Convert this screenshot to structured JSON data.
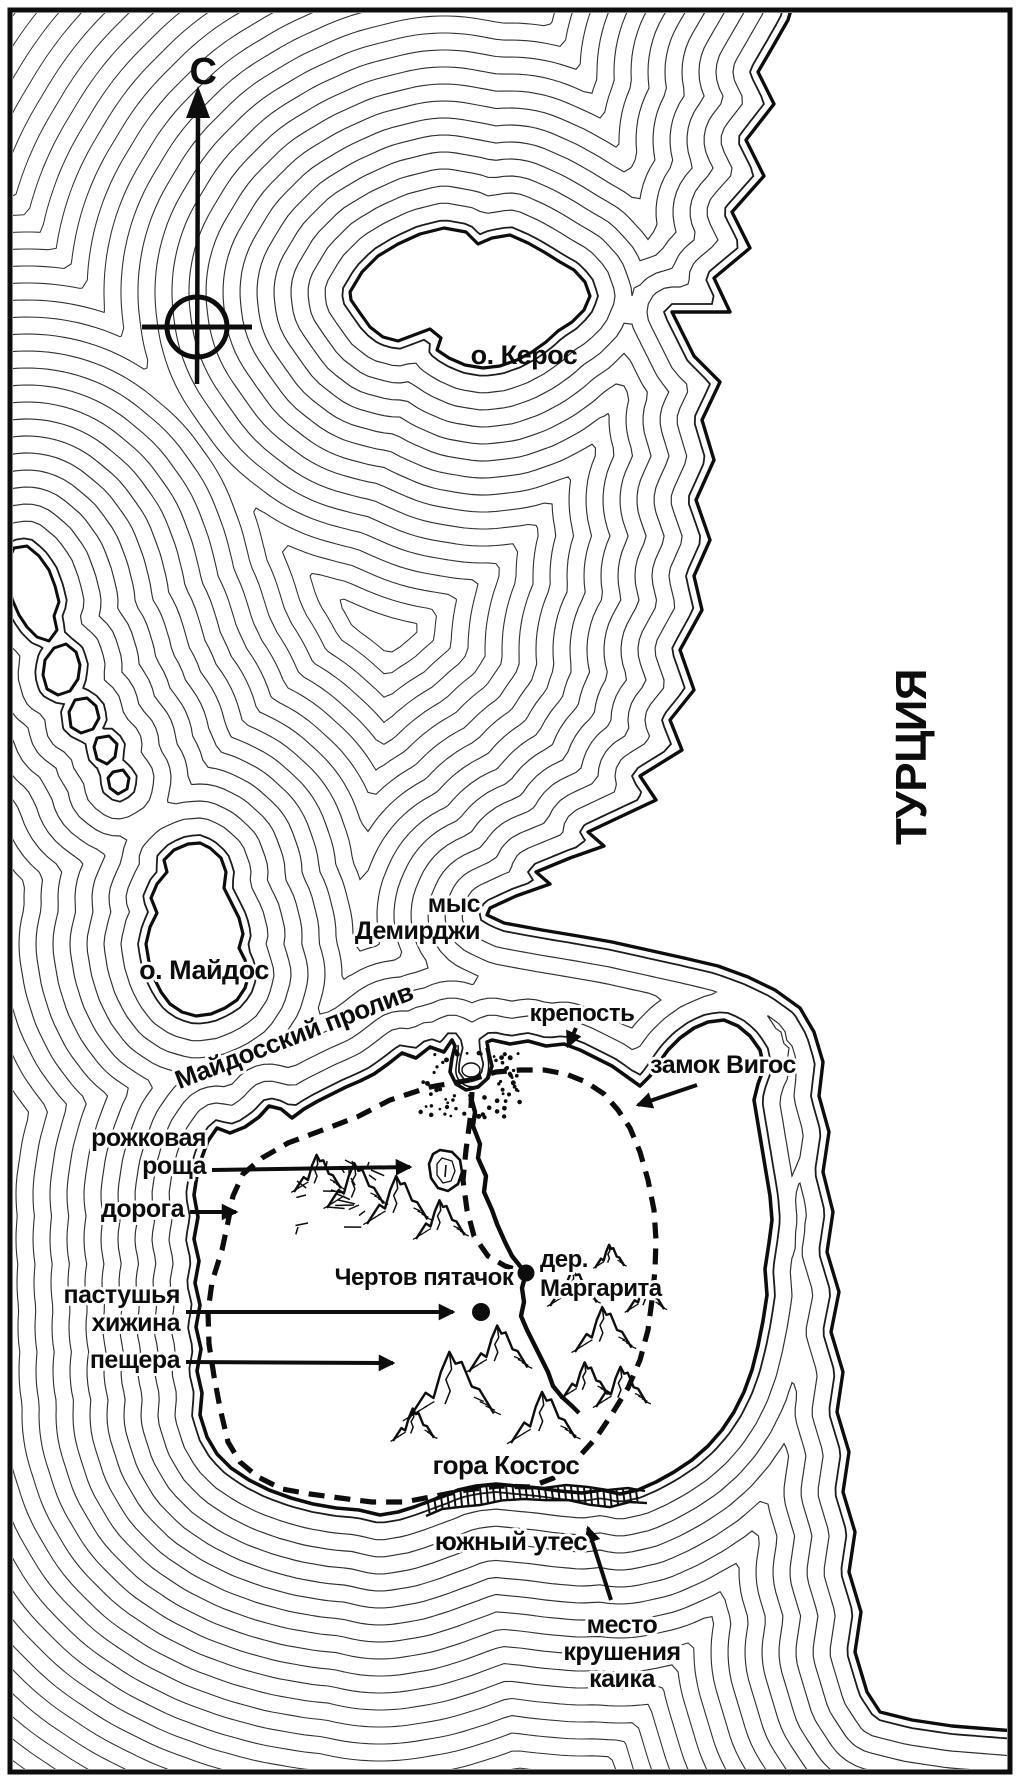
{
  "map": {
    "compass_label": "С",
    "region_label": "ТУРЦИЯ",
    "islands": {
      "keros": "о. Керос",
      "maidos": "о. Майдос"
    },
    "strait_label": "Майдосский пролив",
    "cape": {
      "line1": "мыс",
      "line2": "Демирджи"
    },
    "annotations": {
      "fortress": "крепость",
      "castle": "замок Вигос",
      "grove_line1": "рожковая",
      "grove_line2": "роща",
      "road": "дорога",
      "devils_patch": "Чертов пятачок",
      "village_line1": "дер.",
      "village_line2": "Маргарита",
      "hut_line1": "пастушья",
      "hut_line2": "хижина",
      "cave": "пещера",
      "mountain": "гора Костос",
      "south_cliff": "южный утес",
      "wreck_line1": "место",
      "wreck_line2": "крушения",
      "wreck_line3": "каика"
    },
    "colors": {
      "ink": "#0f0f0f",
      "paper": "#ffffff",
      "contour": "#303030"
    }
  }
}
